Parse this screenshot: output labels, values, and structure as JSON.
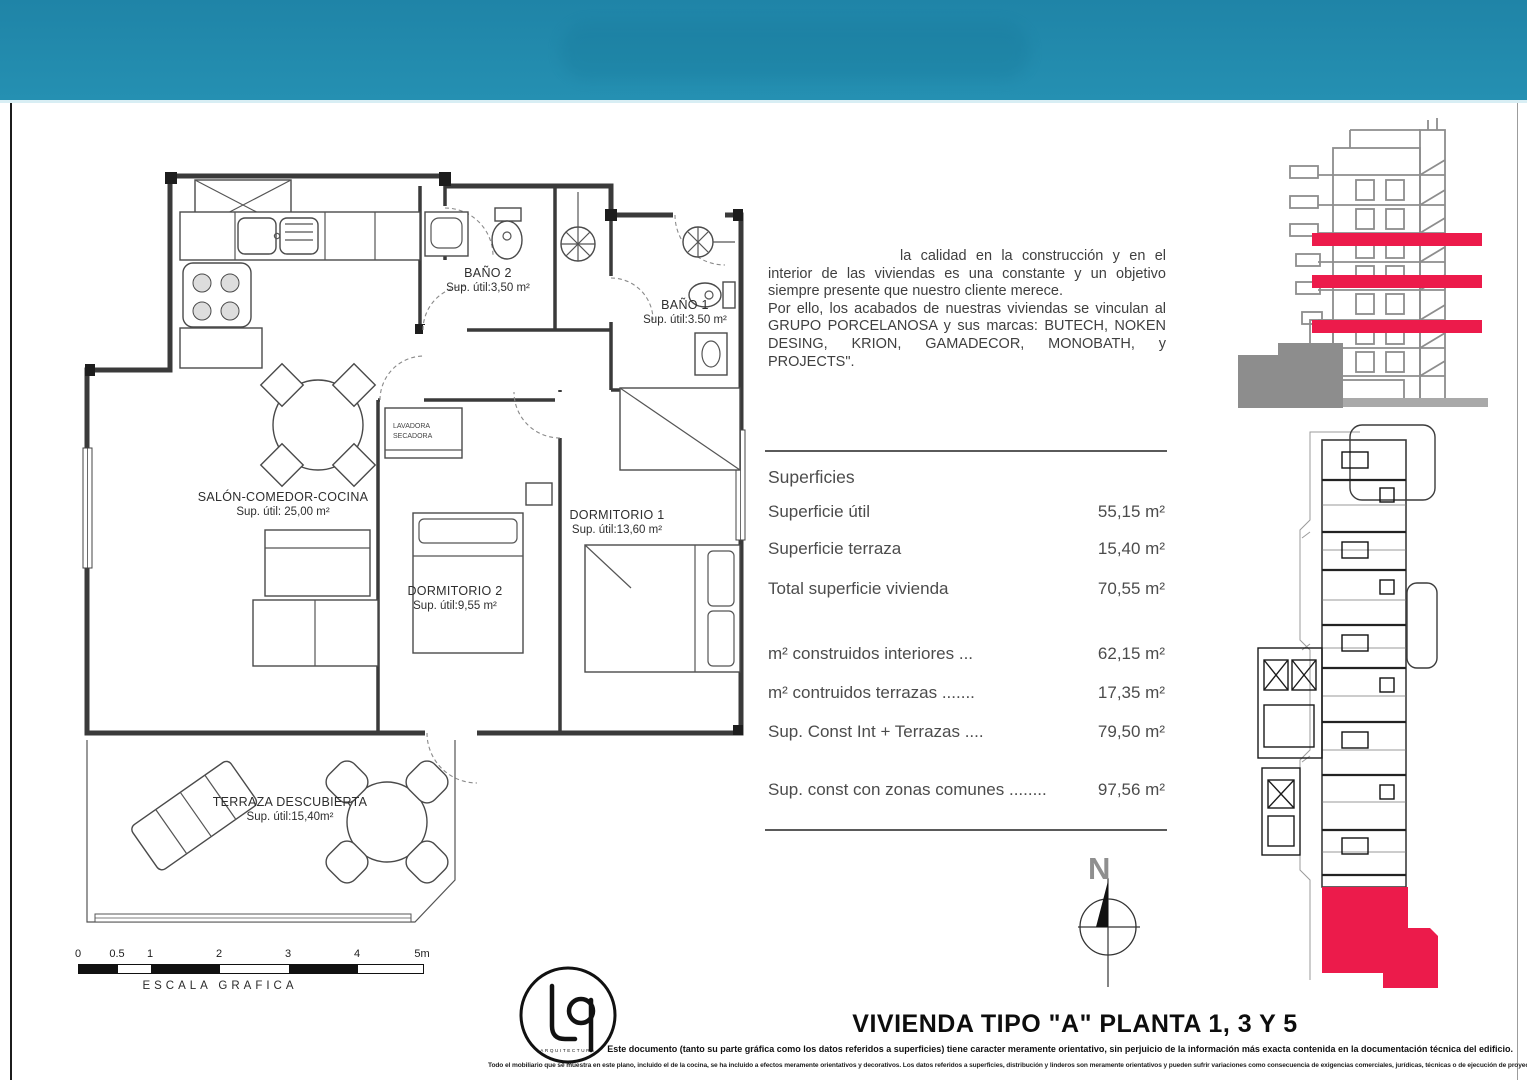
{
  "colors": {
    "band_teal": "#2187ab",
    "accent_red": "#ec1b4b",
    "drawing_gray": "#8d8d8d",
    "ink": "#3a3a3a"
  },
  "floorplan": {
    "rooms": [
      {
        "name": "BAÑO 2",
        "area": "Sup. útil:3,50 m²"
      },
      {
        "name": "BAÑO 1",
        "area": "Sup. útil:3.50 m²"
      },
      {
        "name": "SALÓN-COMEDOR-COCINA",
        "area": "Sup. útil: 25,00 m²"
      },
      {
        "name": "DORMITORIO 1",
        "area": "Sup. útil:13,60 m²"
      },
      {
        "name": "DORMITORIO 2",
        "area": "Sup. útil:9,55 m²"
      },
      {
        "name": "TERRAZA DESCUBIERTA",
        "area": "Sup. útil:15,40m²"
      }
    ],
    "closet": {
      "line1": "LAVADORA",
      "line2": "SECADORA"
    }
  },
  "quality_text": {
    "paragraph1": "la calidad en la construcción y en el interior de las viviendas es una constante y un objetivo siempre presente que nuestro cliente merece.",
    "paragraph2": "Por ello, los acabados de nuestras viviendas se vinculan al GRUPO PORCELANOSA y sus marcas: BUTECH, NOKEN DESING, KRION, GAMADECOR, MONOBATH, y PROJECTS\"."
  },
  "surfaces": {
    "title": "Superficies",
    "rows": [
      {
        "label": "Superficie útil",
        "value": "55,15 m²"
      },
      {
        "label": "Superficie terraza",
        "value": "15,40 m²"
      },
      {
        "label": "Total superficie vivienda",
        "value": "70,55 m²"
      },
      {
        "label": "m² construidos interiores ...",
        "value": "62,15 m²"
      },
      {
        "label": "m² contruidos terrazas .......",
        "value": "17,35 m²"
      },
      {
        "label": "Sup. Const Int + Terrazas ....",
        "value": "79,50 m²"
      },
      {
        "label": "Sup. const con zonas comunes ........",
        "value": "97,56 m²"
      }
    ]
  },
  "scale_bar": {
    "ticks": [
      "0",
      "0.5",
      "1",
      "2",
      "3",
      "4",
      "5m"
    ],
    "label": "ESCALA GRAFICA"
  },
  "compass": {
    "label": "N"
  },
  "logo": {
    "subtext": "ARQUITECTURA"
  },
  "plan_title": "VIVIENDA TIPO \"A\" PLANTA 1, 3 Y 5",
  "disclaimer": {
    "line1": "Este documento (tanto su parte gráfica como los datos referidos a superficies) tiene caracter meramente orientativo, sin perjuicio de la información más exacta contenida en la documentación técnica del edificio.",
    "line2": "Todo el mobiliario que se muestra en este plano, incluido el de la cocina, se ha incluido a efectos meramente orientativos y decorativos. Los datos referidos a superficies, distribución y linderos son meramente orientativos y pueden sufrir variaciones como consecuencia de exigencias comerciales, jurídicas, técnicas o de ejecución de proyecto."
  }
}
